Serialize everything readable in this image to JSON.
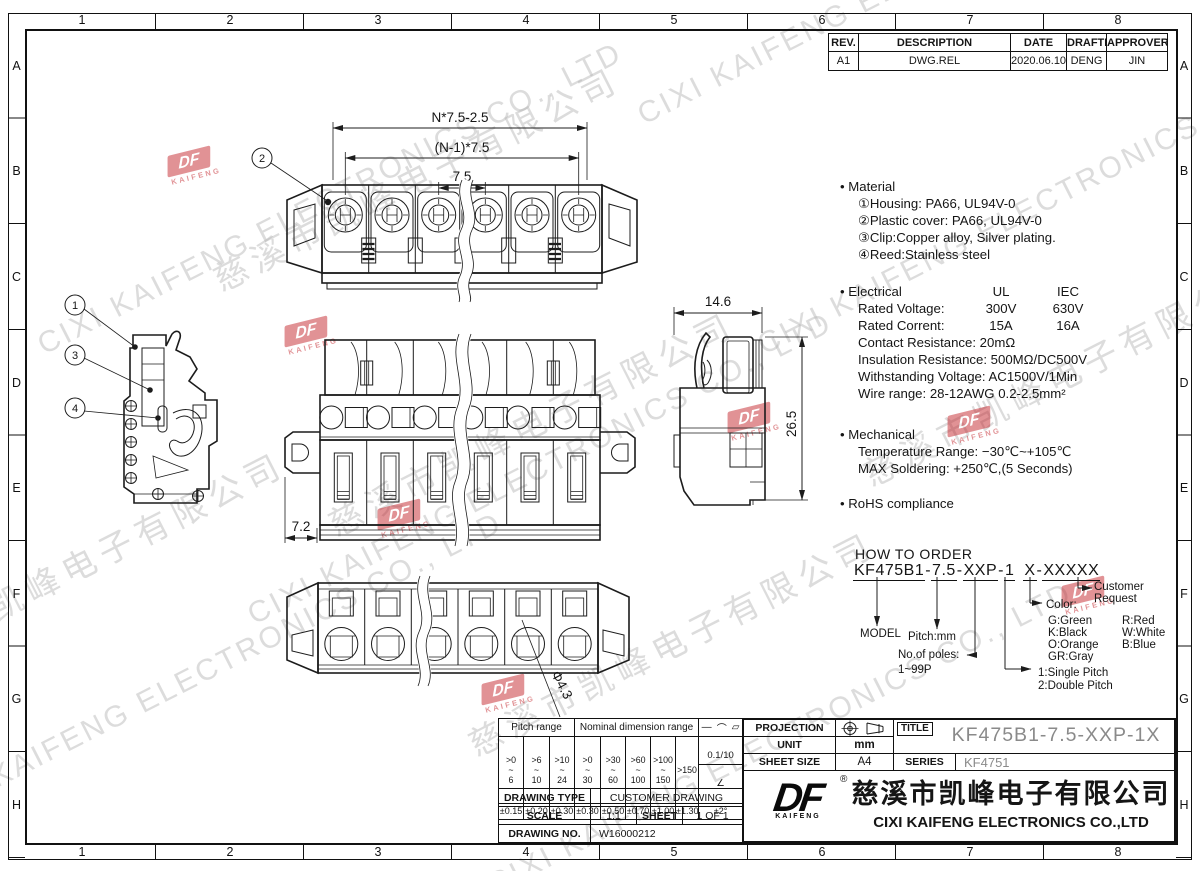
{
  "ui": {
    "grid_cols": [
      "1",
      "2",
      "3",
      "4",
      "5",
      "6",
      "7",
      "8"
    ],
    "grid_rows": [
      "A",
      "B",
      "C",
      "D",
      "E",
      "F",
      "G",
      "H"
    ]
  },
  "watermark": {
    "cn": "慈溪市凯峰电子有限公司",
    "en": "CIXI KAIFENG ELECTRONICS CO., LTD"
  },
  "stamp": {
    "df": "DF",
    "kaifeng": "KAIFENG"
  },
  "revision_table": {
    "headers": {
      "rev": "REV.",
      "description": "DESCRIPTION",
      "date": "DATE",
      "drafter": "DRAFTER",
      "approver": "APPROVER"
    },
    "row": {
      "rev": "A1",
      "description": "DWG.REL",
      "date": "2020.06.10",
      "drafter": "DENG",
      "approver": "JIN"
    }
  },
  "notes": {
    "material": {
      "title": "• Material",
      "item1": "①Housing: PA66, UL94V-0",
      "item2": "②Plastic cover: PA66, UL94V-0",
      "item3": "③Clip:Copper alloy, Silver plating.",
      "item4": "④Reed:Stainless steel"
    },
    "electrical": {
      "title": "• Electrical",
      "ul": "UL",
      "iec": "IEC",
      "row1": {
        "label": "Rated Voltage:",
        "ul": "300V",
        "iec": "630V"
      },
      "row2": {
        "label": "Rated Corrent:",
        "ul": "15A",
        "iec": "16A"
      },
      "line1": "Contact Resistance: 20mΩ",
      "line2": "Insulation Resistance: 500MΩ/DC500V",
      "line3": "Withstanding Voltage: AC1500V/1Min",
      "line4": "Wire range: 28-12AWG  0.2-2.5mm²"
    },
    "mechanical": {
      "title": "• Mechanical",
      "item1": "Temperature Range: −30℃~+105℃",
      "item2": "MAX Soldering: +250℃,(5 Seconds)"
    },
    "rohs": "• RoHS compliance"
  },
  "dimensions": {
    "top_view": {
      "overall": "N*7.5-2.5",
      "centers": "(N-1)*7.5",
      "pitch": "7.5"
    },
    "front_view": {
      "flange": "7.2"
    },
    "side_view": {
      "width": "14.6",
      "height": "26.5"
    },
    "bottom_view": {
      "hole": "Φ4.3"
    },
    "callout1": "1",
    "callout2": "2",
    "callout3": "3",
    "callout4": "4"
  },
  "how_to_order": {
    "title": "HOW TO ORDER",
    "code": {
      "s1": "KF475B1",
      "d1": "-",
      "s2": "7.5",
      "d2": "-",
      "s3": "XXP",
      "d3": "-",
      "s4": "1",
      "s5": "X",
      "d4": "-",
      "s6": "XXXXX"
    },
    "model_label": "MODEL",
    "pitch_label": "Pitch:mm",
    "poles_label": "No.of poles:",
    "poles_range": "1~99P",
    "single": "1:Single Pitch",
    "double": "2:Double Pitch",
    "color_label": "Color:",
    "c1": "G:Green",
    "c2": "R:Red",
    "c3": "K:Black",
    "c4": "W:White",
    "c5": "O:Orange",
    "c6": "B:Blue",
    "c7": "GR:Gray",
    "customer": "Customer",
    "request": "Request"
  },
  "tolerance_table": {
    "pitch_header": "Pitch range",
    "dim_header": "Nominal dimension range",
    "sym1": "—",
    "sym2": "⌒",
    "sym3": "▱",
    "p1": ">0\n~\n6",
    "p2": ">6\n~\n10",
    "p3": ">10\n~\n24",
    "n1": ">0\n~\n30",
    "n2": ">30\n~\n60",
    "n3": ">60\n~\n100",
    "n4": ">100\n~\n150",
    "n5": ">150",
    "flat": "0.1/10",
    "angle_sym": "∠",
    "t1": "±0.15",
    "t2": "±0.20",
    "t3": "±0.30",
    "t4": "±0.30",
    "t5": "±0.50",
    "t6": "±0.70",
    "t7": "±1.00",
    "t8": "±1.30",
    "t9": "±2°"
  },
  "drawing_info": {
    "type_label": "DRAWING TYPE",
    "type_value": "CUSTOMER DRAWING",
    "scale_label": "SCALE",
    "scale_value": "1:1",
    "sheet_label": "SHEET",
    "sheet_value": "1 OF 1",
    "no_label": "DRAWING NO.",
    "no_value": "W16000212"
  },
  "title_block": {
    "projection_label": "PROJECTION",
    "unit_label": "UNIT",
    "unit_value": "mm",
    "sheet_size_label": "SHEET SIZE",
    "sheet_size_value": "A4",
    "title_label": "TITLE",
    "title_value": "KF475B1-7.5-XXP-1X",
    "series_label": "SERIES",
    "series_value": "KF4751",
    "registered": "®",
    "company_cn": "慈溪市凯峰电子有限公司",
    "company_en": "CIXI KAIFENG ELECTRONICS CO.,LTD"
  }
}
